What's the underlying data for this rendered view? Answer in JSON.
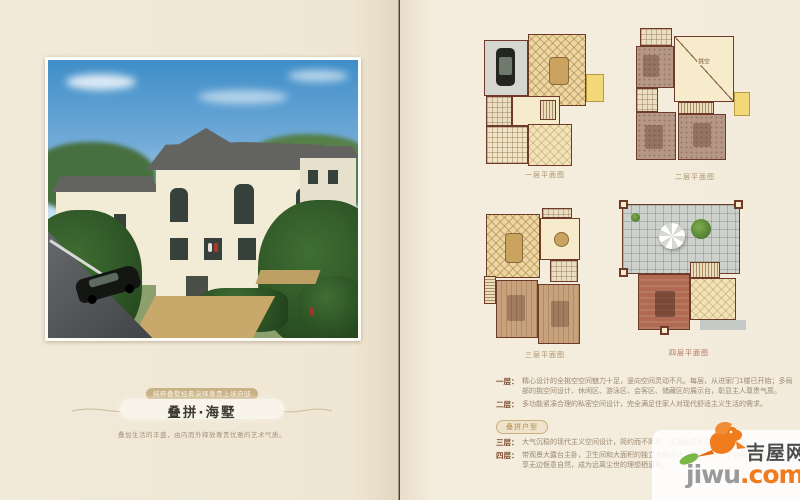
{
  "left_page": {
    "ribbon_label": "纯粹叠墅经典演绎尊贵上境府邸",
    "title": "叠拼·海墅",
    "subtitle": "叠加生活的丰盛，由内而外释放尊贵优雅的艺术气质。"
  },
  "right_page": {
    "plans": [
      {
        "caption": "一层平面图"
      },
      {
        "caption": "二层平面图",
        "void_label": "挑空"
      },
      {
        "caption": "三层平面图"
      },
      {
        "caption": "四层平面图"
      }
    ],
    "type_badge": "叠拼户型",
    "descriptions": [
      {
        "label": "一层：",
        "text": "精心设计的全挑空空间魅力十足，竖向空间灵动不凡。每层，从进家门1楼已开始；多局部的挑空间设计、休闲区、游泳区、会客区、储藏区的展示台，彰显主人尊贵气质。"
      },
      {
        "label": "二层：",
        "text": "多功能紧凑合理的私密空间设计，完全满足住家人对现代舒适主义生活的需求。"
      },
      {
        "label": "三层：",
        "text": "大气沉稳的现代主义空间设计，简约而不简单，生活品质尽显于细节之中。"
      },
      {
        "label": "四层：",
        "text": "带观景大露台主卧，卫生间和大面积的独立衣帽设计，奢华大气。空中花园私密自在，尽享无边惬意自然，成为远离尘世的理想栖息地。"
      }
    ]
  },
  "watermark": {
    "cn": "吉屋网",
    "en_gray": "jiwu",
    "en_orange": ".com"
  },
  "colors": {
    "accent_orange": "#f07c1e",
    "leaf_green": "#7ab648",
    "wall_brown": "#6e3a2a",
    "balcony_yellow": "#f2d878",
    "page_cream": "#f2ead9"
  }
}
